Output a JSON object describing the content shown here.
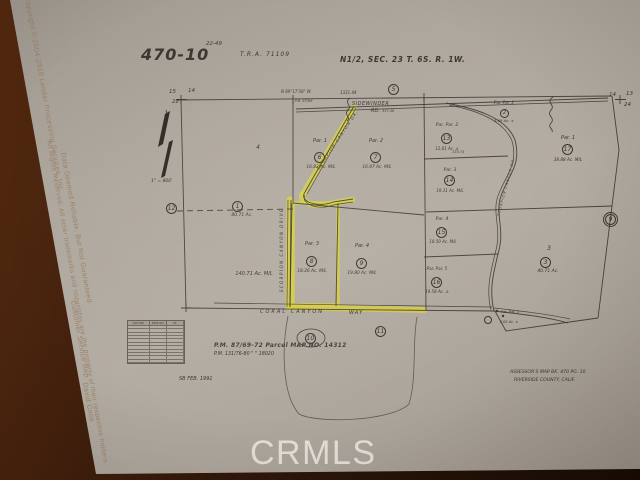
{
  "title_block": {
    "map_number": "470-10",
    "map_number_sup": "22-49",
    "tra": "T.R.A.   71109",
    "legal": "N1/2, SEC. 23 T. 6S. R. 1W."
  },
  "corners": {
    "tl_a": "15",
    "tl_b": "14",
    "tl_c": "22",
    "tr_a": "14",
    "tr_b": "13",
    "tr_c": "24"
  },
  "refs": {
    "top": "5",
    "left": "12",
    "right": "9",
    "oval": "10",
    "bottom": "11",
    "dashed": "1"
  },
  "survey": {
    "bearing": "N 89°17'38\" W",
    "dim_1321": "1321.44",
    "pb": "P.B. 87/68",
    "dim_133": "133.74",
    "dim_337": "337.48",
    "scale": "1\" = 800'"
  },
  "roads": {
    "sidewinder": "SIDEWINDER",
    "sidewinder_rd": "RD.",
    "scorpion_diagonal": "SCORPION CANYON DR.",
    "scorpion_vertical": "SCORPION CANYON DRIVE",
    "coral": "CORAL   CANYON",
    "coral_way": "WAY"
  },
  "parcels": [
    {
      "name": "4",
      "area": "140.71 Ac. M/L"
    },
    {
      "num": "1",
      "area": "80.71 Ac."
    },
    {
      "name": "Par. 1",
      "num": "6",
      "area": "16.82 Ac. M/L"
    },
    {
      "name": "Par. 2",
      "num": "7",
      "area": "16.97 Ac. M/L"
    },
    {
      "name": "Par. 3",
      "num": "8",
      "area": "18.26 Ac. M/L"
    },
    {
      "name": "Par. 4",
      "num": "9",
      "area": "19.80 Ac. M/L"
    },
    {
      "name": "Par. Par. 2",
      "num": "2",
      "area": "3.69 Ac. ±"
    },
    {
      "name": "Par. Par. 2",
      "num": "13",
      "area": "12.61 Ac. ±"
    },
    {
      "name": "Par. 3",
      "num": "14",
      "area": "19.31 Ac. M/L"
    },
    {
      "name": "Par. 4",
      "num": "15",
      "area": "18.50 Ac. M/L"
    },
    {
      "name": "Par. Par. 5",
      "num": "16",
      "area": "19.58 Ac. ±"
    },
    {
      "name": "Par. 1",
      "num": "17",
      "area": "38.88 Ac. M/L"
    },
    {
      "name": "3",
      "num": "3",
      "area": "40.71 Ac."
    },
    {
      "name": "Par. Par. 5",
      "area": "5.05 Ac. ±"
    }
  ],
  "notes": {
    "pm1": "P.M. 87/69-72    Parcel MAP NO. 14312",
    "pm2": "P.M. 131/76-80        \"          \"        18020",
    "date": "SB  FEB. 1991",
    "assessor1": "ASSESSOR'S MAP BK. 470 PG. 10",
    "assessor2": "RIVERSIDE COUNTY, CALIF."
  },
  "table": {
    "h1": "OLD NO.",
    "h2": "NEW NO.",
    "h3": "YR."
  },
  "watermarks": {
    "crmls": "CRMLS",
    "date_fragment": "8/2019",
    "c1": "Copyright © 2004-2019 Lender Processing Services, Inc.",
    "c2": "All Rights Reserved. All other trademarks and copyrights are the property of their respective holders.",
    "c3": "Data Deemed Reliable, But Not Guaranteed.",
    "c4": "Customer Service Rep",
    "c5": "David Cook"
  }
}
